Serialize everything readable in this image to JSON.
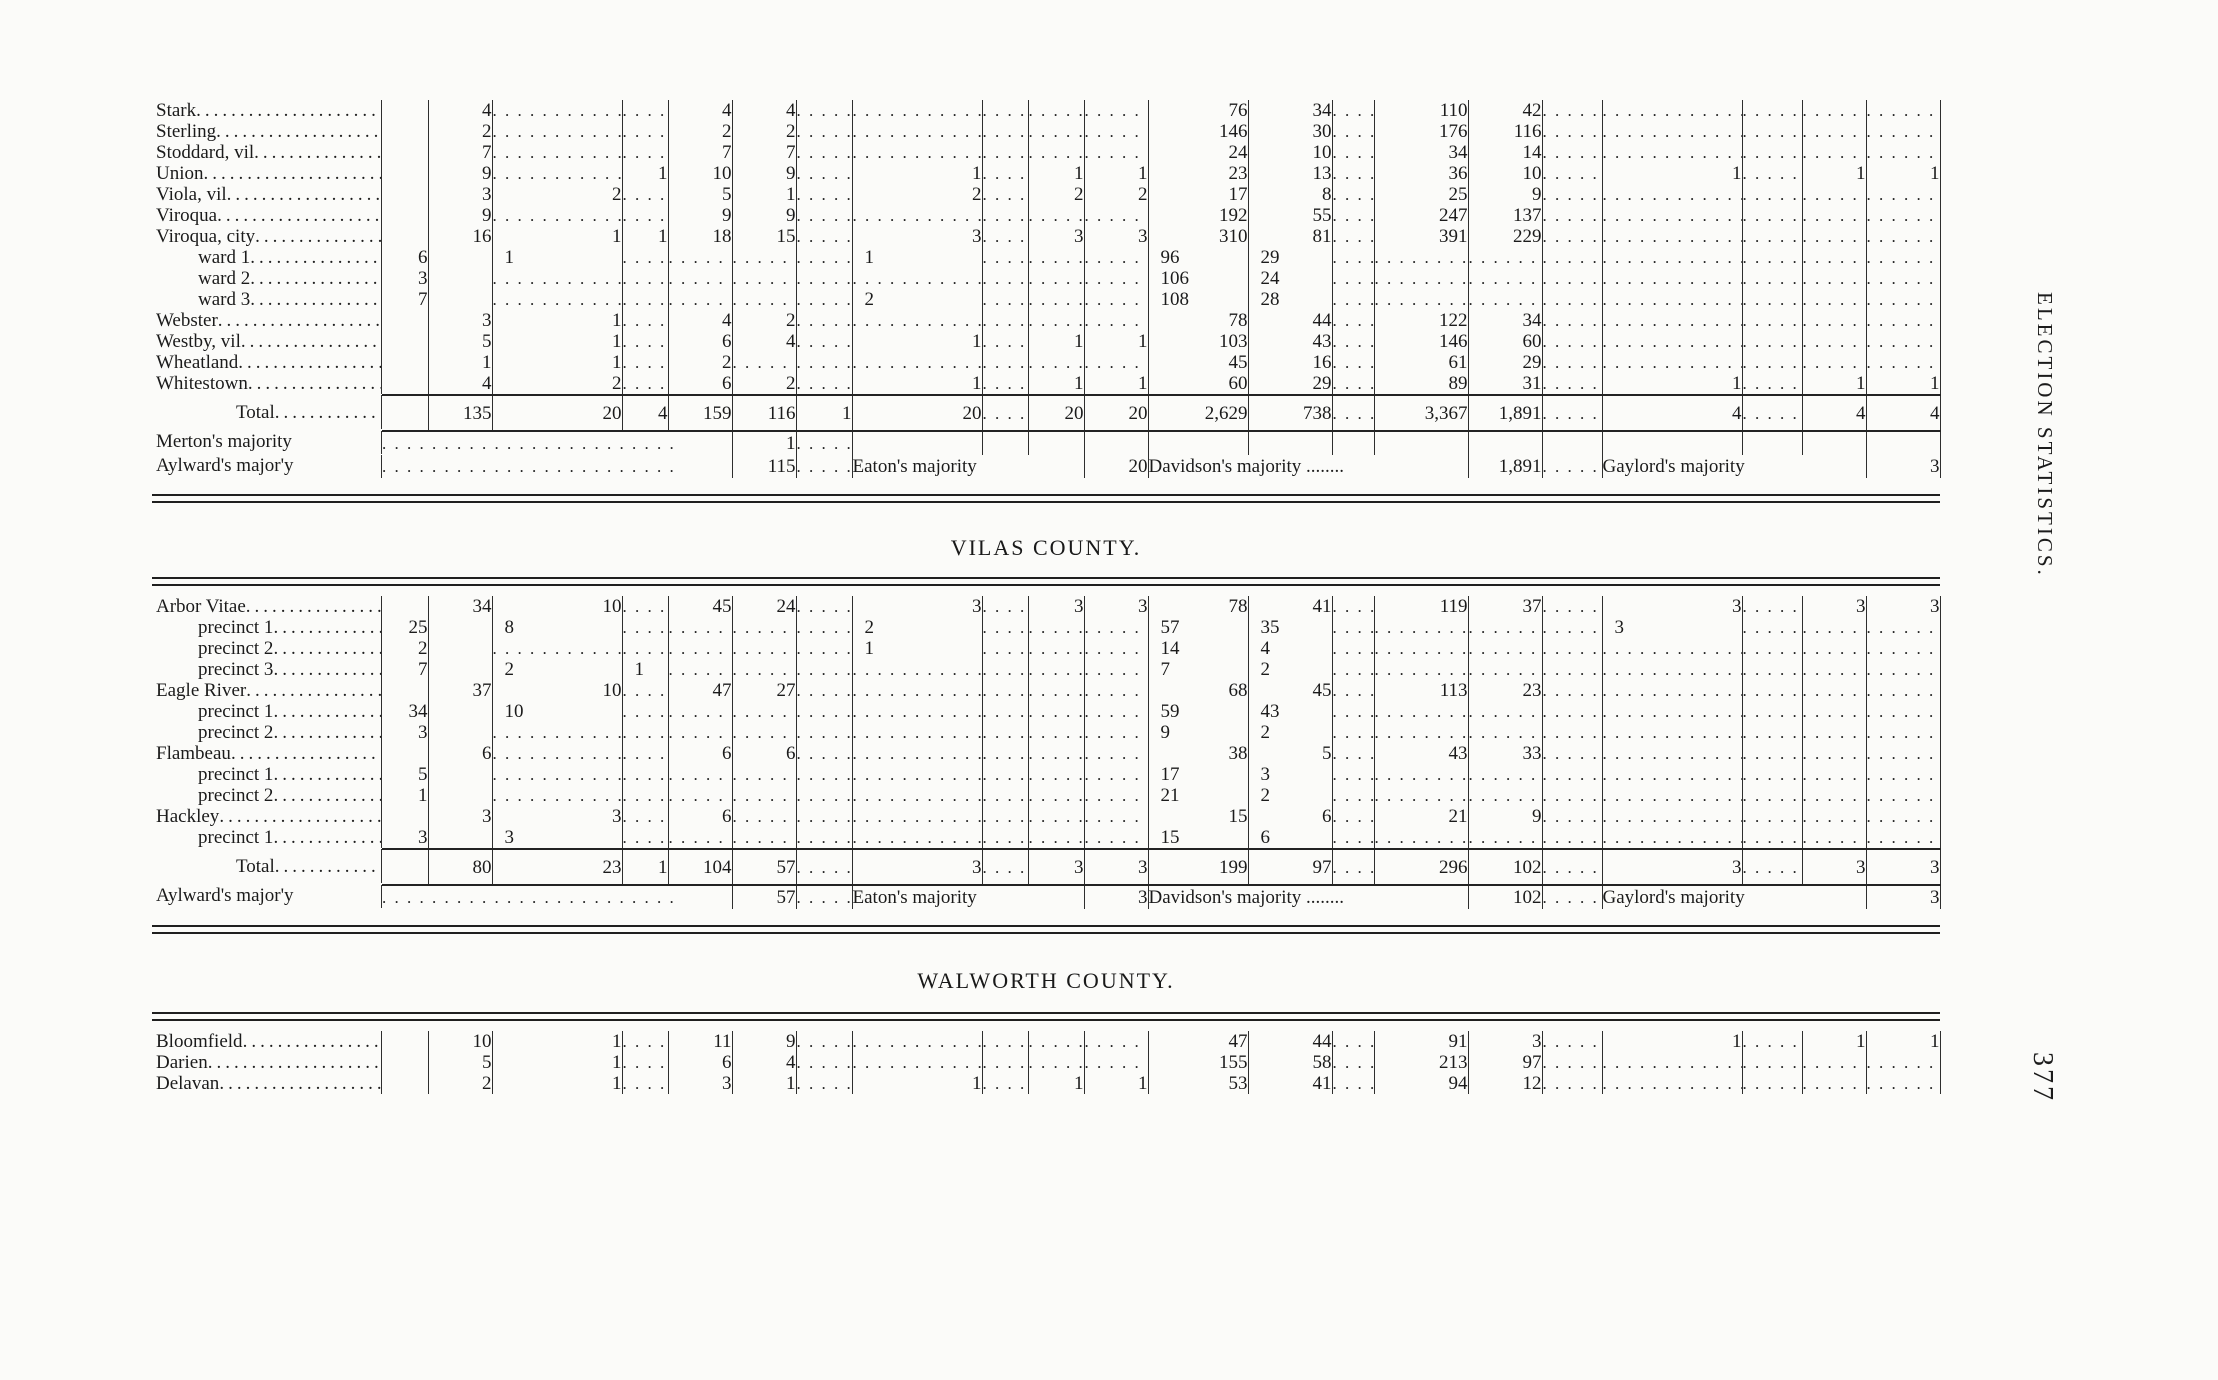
{
  "page": {
    "side_text": "ELECTION STATISTICS.",
    "page_number": "377"
  },
  "sections": [
    {
      "heading": "",
      "rows": [
        {
          "n": "Stark",
          "t": "b",
          "c": [
            "",
            "4",
            "..........",
            "....",
            "4",
            "4",
            "......",
            "..........",
            "....",
            "....",
            "......",
            "76",
            "34",
            "....",
            "110",
            "42",
            "......",
            "..........",
            "......",
            "....",
            "......"
          ]
        },
        {
          "n": "Sterling",
          "t": "b",
          "c": [
            "",
            "2",
            "..........",
            "....",
            "2",
            "2",
            "......",
            "..........",
            "....",
            "....",
            "......",
            "146",
            "30",
            "....",
            "176",
            "116",
            "......",
            "..........",
            "......",
            "....",
            "......"
          ]
        },
        {
          "n": "Stoddard, vil",
          "t": "b",
          "c": [
            "",
            "7",
            "..........",
            "....",
            "7",
            "7",
            "......",
            "..........",
            "....",
            "....",
            "......",
            "24",
            "10",
            "....",
            "34",
            "14",
            "......",
            "..........",
            "......",
            "....",
            "......"
          ]
        },
        {
          "n": "Union",
          "t": "b",
          "c": [
            "",
            "9",
            "..........",
            "1",
            "10",
            "9",
            "......",
            "1",
            "....",
            "1",
            "1",
            "23",
            "13",
            "....",
            "36",
            "10",
            "......",
            "1",
            "......",
            "1",
            "1"
          ]
        },
        {
          "n": "Viola, vil",
          "t": "b",
          "c": [
            "",
            "3",
            "2",
            "....",
            "5",
            "1",
            "......",
            "2",
            "....",
            "2",
            "2",
            "17",
            "8",
            "....",
            "25",
            "9",
            "......",
            "..........",
            "......",
            "....",
            "......"
          ]
        },
        {
          "n": "Viroqua",
          "t": "b",
          "c": [
            "",
            "9",
            "..........",
            "....",
            "9",
            "9",
            "......",
            "..........",
            "....",
            "....",
            "......",
            "192",
            "55",
            "....",
            "247",
            "137",
            "......",
            "..........",
            "......",
            "....",
            "......"
          ]
        },
        {
          "n": "Viroqua, city",
          "t": "b",
          "c": [
            "",
            "16",
            "1",
            "1",
            "18",
            "15",
            "......",
            "3",
            "....",
            "3",
            "3",
            "310",
            "81",
            "....",
            "391",
            "229",
            "......",
            "..........",
            "......",
            "....",
            "......"
          ]
        },
        {
          "n": "ward 1",
          "t": "b",
          "i": 1,
          "c": [
            "6",
            "",
            "1",
            "....",
            "......",
            "......",
            "......",
            "1",
            "....",
            "....",
            "....",
            "96",
            "29",
            "....",
            "......",
            "......",
            "......",
            "......",
            "......",
            "....",
            "......"
          ]
        },
        {
          "n": "ward 2",
          "t": "b",
          "i": 1,
          "c": [
            "3",
            "",
            "..........",
            "....",
            "......",
            "......",
            "......",
            "..........",
            "....",
            "....",
            "....",
            "106",
            "24",
            "....",
            "......",
            "......",
            "......",
            "......",
            "......",
            "....",
            "......"
          ]
        },
        {
          "n": "ward 3",
          "t": "b",
          "i": 1,
          "c": [
            "7",
            "",
            "..........",
            "....",
            "......",
            "......",
            "......",
            "2",
            "....",
            "....",
            "....",
            "108",
            "28",
            "....",
            "......",
            "......",
            "......",
            "......",
            "......",
            "....",
            "......"
          ]
        },
        {
          "n": "Webster",
          "t": "b",
          "c": [
            "",
            "3",
            "1",
            "....",
            "4",
            "2",
            "......",
            "..........",
            "....",
            "....",
            "......",
            "78",
            "44",
            "....",
            "122",
            "34",
            "......",
            "..........",
            "......",
            "....",
            "......"
          ]
        },
        {
          "n": "Westby, vil",
          "t": "b",
          "c": [
            "",
            "5",
            "1",
            "....",
            "6",
            "4",
            "......",
            "1",
            "....",
            "1",
            "1",
            "103",
            "43",
            "....",
            "146",
            "60",
            "......",
            "..........",
            "......",
            "....",
            "......"
          ]
        },
        {
          "n": "Wheatland",
          "t": "b",
          "c": [
            "",
            "1",
            "1",
            "....",
            "2",
            "......",
            "......",
            "..........",
            "....",
            "....",
            "......",
            "45",
            "16",
            "....",
            "61",
            "29",
            "......",
            "..........",
            "......",
            "....",
            "......"
          ]
        },
        {
          "n": "Whitestown",
          "t": "b",
          "c": [
            "",
            "4",
            "2",
            "..",
            "6",
            "2",
            "......",
            "1",
            "..",
            "1",
            "1",
            "60",
            "29",
            "....",
            "89",
            "31",
            "......",
            "1",
            "......",
            "1",
            "1"
          ]
        },
        {
          "n": "Total",
          "t": "t",
          "c": [
            "",
            "135",
            "20",
            "4",
            "159",
            "116",
            "1",
            "20",
            "....",
            "20",
            "20",
            "2,629",
            "738",
            "....",
            "3,367",
            "1,891",
            "......",
            "4",
            "......",
            "4",
            "4"
          ]
        },
        {
          "n": "Merton's majority",
          "t": "m",
          "c": [
            {
              "v": "................................",
              "s": 5
            },
            "1",
            "..",
            "",
            "",
            "",
            "",
            "",
            "",
            "",
            "",
            "",
            "",
            "",
            "",
            "",
            ""
          ]
        },
        {
          "n": "Aylward's major'y",
          "t": "m",
          "c": [
            {
              "v": "................................",
              "s": 5
            },
            "115",
            "......",
            {
              "v": "Eaton's majority",
              "s": 3
            },
            "20",
            {
              "v": "Davidson's majority ........",
              "s": 4
            },
            "1,891",
            "......",
            {
              "v": "Gaylord's majority",
              "s": 3
            },
            "3"
          ]
        }
      ]
    },
    {
      "heading": "VILAS COUNTY.",
      "rows": [
        {
          "n": "Arbor Vitae",
          "t": "b",
          "c": [
            "",
            "34",
            "10",
            "....",
            "45",
            "24",
            "......",
            "3",
            "....",
            "3",
            "3",
            "78",
            "41",
            "..",
            "119",
            "37",
            "......",
            "3",
            "....",
            "3",
            "3"
          ]
        },
        {
          "n": "precinct 1",
          "t": "b",
          "i": 1,
          "c": [
            "25",
            "",
            "8",
            "....",
            "......",
            "......",
            "......",
            "2",
            "....",
            "....",
            "....",
            "57",
            "35",
            "....",
            "......",
            "......",
            "......",
            "3",
            "......",
            "....",
            "......"
          ]
        },
        {
          "n": "precinct 2",
          "t": "b",
          "i": 1,
          "c": [
            "2",
            "",
            "..........",
            "....",
            "......",
            "......",
            "......",
            "1",
            "....",
            "....",
            "....",
            "14",
            "4",
            "....",
            "......",
            "......",
            "......",
            "......",
            "......",
            "....",
            "......"
          ]
        },
        {
          "n": "precinct 3",
          "t": "b",
          "i": 1,
          "c": [
            "7",
            "",
            "2",
            "1",
            "......",
            "......",
            "......",
            "..........",
            "....",
            "....",
            "....",
            "7",
            "2",
            "....",
            "......",
            "......",
            "......",
            "......",
            "......",
            "....",
            "......"
          ]
        },
        {
          "n": "Eagle River",
          "t": "b",
          "c": [
            "",
            "37",
            "10",
            "....",
            "47",
            "27",
            "......",
            "..........",
            "....",
            "....",
            "......",
            "68",
            "45",
            "....",
            "113",
            "23",
            "......",
            "..........",
            "......",
            "....",
            "......"
          ]
        },
        {
          "n": "precinct 1",
          "t": "b",
          "i": 1,
          "c": [
            "34",
            "",
            "10",
            "....",
            "......",
            "......",
            "......",
            "..........",
            "....",
            "....",
            "....",
            "59",
            "43",
            "....",
            "......",
            "......",
            "......",
            "......",
            "......",
            "....",
            "......"
          ]
        },
        {
          "n": "precinct 2",
          "t": "b",
          "i": 1,
          "c": [
            "3",
            "",
            "..........",
            "....",
            "......",
            "......",
            "......",
            "..........",
            "....",
            "....",
            "....",
            "9",
            "2",
            "....",
            "......",
            "......",
            "......",
            "......",
            "......",
            "....",
            "......"
          ]
        },
        {
          "n": "Flambeau",
          "t": "b",
          "c": [
            "",
            "6",
            "..........",
            "....",
            "6",
            "6",
            "......",
            "..........",
            "....",
            "....",
            "......",
            "38",
            "5",
            "....",
            "43",
            "33",
            "......",
            "..........",
            "......",
            "....",
            "......"
          ]
        },
        {
          "n": "precinct 1",
          "t": "b",
          "i": 1,
          "c": [
            "5",
            "",
            "..........",
            "....",
            "......",
            "......",
            "......",
            "..........",
            "....",
            "....",
            "....",
            "17",
            "3",
            "....",
            "......",
            "......",
            "......",
            "......",
            "......",
            "....",
            "......"
          ]
        },
        {
          "n": "precinct 2",
          "t": "b",
          "i": 1,
          "c": [
            "1",
            "",
            "..........",
            "....",
            "......",
            "......",
            "......",
            "..........",
            "....",
            "....",
            "....",
            "21",
            "2",
            "....",
            "......",
            "......",
            "......",
            "......",
            "......",
            "....",
            "......"
          ]
        },
        {
          "n": "Hackley",
          "t": "b",
          "c": [
            "",
            "3",
            "3",
            "....",
            "6",
            "......",
            "......",
            "..........",
            "....",
            "....",
            "......",
            "15",
            "6",
            "..",
            "21",
            "9",
            "......",
            "..........",
            "......",
            "....",
            "......"
          ]
        },
        {
          "n": "precinct 1",
          "t": "b",
          "i": 1,
          "c": [
            "3",
            "",
            "3",
            "....",
            "......",
            "......",
            "......",
            "..........",
            "....",
            "....",
            "....",
            "15",
            "6",
            "....",
            "......",
            "......",
            "......",
            "......",
            "......",
            "....",
            "......"
          ]
        },
        {
          "n": "Total",
          "t": "t",
          "c": [
            "",
            "80",
            "23",
            "1",
            "104",
            "57",
            "......",
            "3",
            "....",
            "3",
            "3",
            "199",
            "97",
            "..",
            "296",
            "102",
            "......",
            "3",
            "......",
            "3",
            "3"
          ]
        },
        {
          "n": "Aylward's major'y",
          "t": "m",
          "c": [
            {
              "v": "................................",
              "s": 5
            },
            "57",
            "......",
            {
              "v": "Eaton's majority",
              "s": 3
            },
            "3",
            {
              "v": "Davidson's majority ........",
              "s": 4
            },
            "102",
            "......",
            {
              "v": "Gaylord's majority",
              "s": 3
            },
            "3"
          ]
        }
      ]
    },
    {
      "heading": "WALWORTH COUNTY.",
      "rows": [
        {
          "n": "Bloomfield",
          "t": "b",
          "c": [
            "",
            "10",
            "1",
            "....",
            "11",
            "9",
            "......",
            "..........",
            "....",
            "....",
            "......",
            "47",
            "44",
            "....",
            "91",
            "3",
            "......",
            "1",
            "......",
            "1",
            "1"
          ]
        },
        {
          "n": "Darien",
          "t": "b",
          "c": [
            "",
            "5",
            "1",
            "....",
            "6",
            "4",
            "......",
            "..........",
            "....",
            "....",
            "......",
            "155",
            "58",
            "....",
            "213",
            "97",
            "......",
            "..........",
            "......",
            "....",
            "......"
          ]
        },
        {
          "n": "Delavan",
          "t": "b",
          "c": [
            "",
            "2",
            "1",
            "....",
            "3",
            "1",
            "......",
            "1",
            "....",
            "1",
            "1",
            "53",
            "41",
            "....",
            "94",
            "12",
            "......",
            "..........",
            "......",
            "....",
            "......"
          ]
        }
      ]
    }
  ]
}
